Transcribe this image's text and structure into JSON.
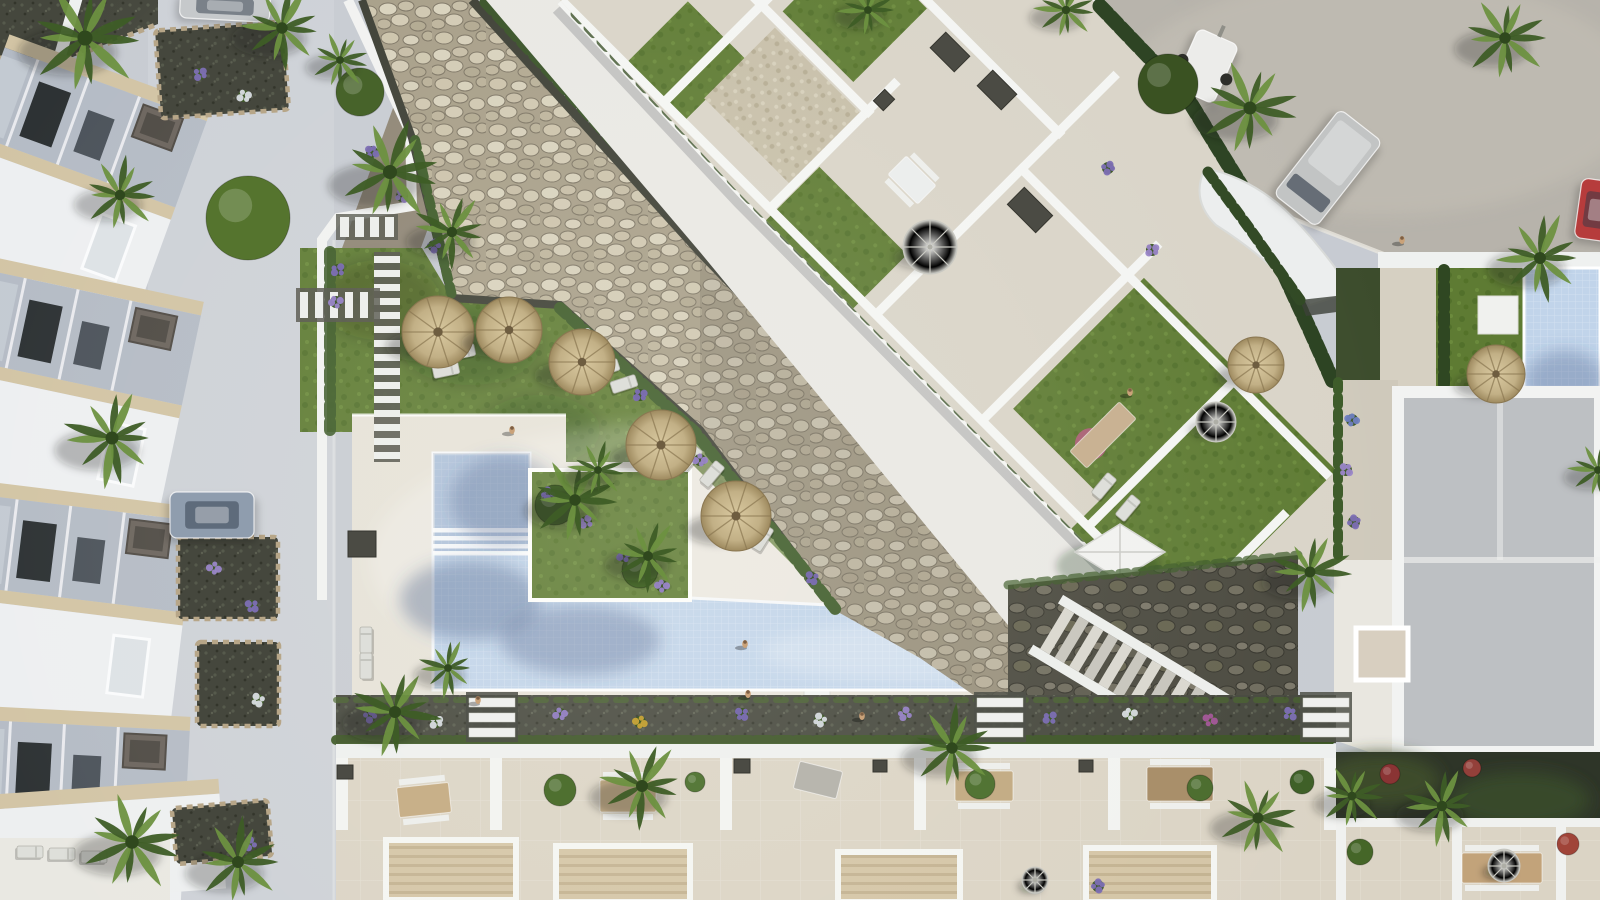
{
  "scene": {
    "kind": "aerial-architectural-render",
    "description": "Top-down 3D render of a Mediterranean residential complex: apartment block with roof terraces, communal lawn with thatched parasols, L-shaped pool, townhouse rows, streets with parked vehicles, stone bank and landscaped gardens",
    "palette": {
      "pavement": "#c7cbd2",
      "street": "#cdd1d7",
      "road": "#b7b3ab",
      "deck": "#e6e2d8",
      "walkway": "#e9e8e4",
      "wall_white": "#f2f3f2",
      "roof_white": "#edeff1",
      "eave_beige": "#d2c4a4",
      "facade": "#b4bbc5",
      "window_dark": "#2b3032",
      "lawn": "#5e7b33",
      "lawn_shade": "#47642a",
      "hedge": "#34501f",
      "riprap": "#a79e88",
      "stone_light": "#d8d2bd",
      "gravel_dark": "#45473d",
      "water": "#bfd3ea",
      "water_shadow": "#6e8cb8",
      "thatch": "#c9b88c",
      "terrace_tile": "#dbd4c5",
      "pergola": "#d0c1a2",
      "villa_roof": "#bdc0c3",
      "veg_dark": "#2e3528",
      "stone_border": "#b7a688"
    }
  },
  "left_houses": {
    "units": [
      {
        "y": 38,
        "rot": 20
      },
      {
        "y": 261,
        "rot": 12
      },
      {
        "y": 484,
        "rot": 7
      },
      {
        "y": 707,
        "rot": 3
      }
    ]
  },
  "objects": {
    "palms": [
      {
        "x": 85,
        "y": 38,
        "r": 58
      },
      {
        "x": 282,
        "y": 28,
        "r": 44
      },
      {
        "x": 390,
        "y": 172,
        "r": 54
      },
      {
        "x": 452,
        "y": 232,
        "r": 40
      },
      {
        "x": 120,
        "y": 195,
        "r": 40
      },
      {
        "x": 112,
        "y": 438,
        "r": 50
      },
      {
        "x": 132,
        "y": 842,
        "r": 52
      },
      {
        "x": 238,
        "y": 862,
        "r": 46
      },
      {
        "x": 575,
        "y": 500,
        "r": 44
      },
      {
        "x": 648,
        "y": 556,
        "r": 38
      },
      {
        "x": 598,
        "y": 470,
        "r": 30
      },
      {
        "x": 395,
        "y": 712,
        "r": 46
      },
      {
        "x": 448,
        "y": 668,
        "r": 30
      },
      {
        "x": 642,
        "y": 786,
        "r": 46
      },
      {
        "x": 952,
        "y": 748,
        "r": 44
      },
      {
        "x": 1258,
        "y": 818,
        "r": 42
      },
      {
        "x": 1442,
        "y": 806,
        "r": 40
      },
      {
        "x": 1352,
        "y": 796,
        "r": 34
      },
      {
        "x": 1310,
        "y": 572,
        "r": 42
      },
      {
        "x": 1250,
        "y": 108,
        "r": 50
      },
      {
        "x": 1505,
        "y": 38,
        "r": 44
      },
      {
        "x": 1540,
        "y": 258,
        "r": 46
      },
      {
        "x": 868,
        "y": 10,
        "r": 30
      },
      {
        "x": 1066,
        "y": 10,
        "r": 32
      },
      {
        "x": 340,
        "y": 60,
        "r": 30
      },
      {
        "x": 1598,
        "y": 470,
        "r": 30
      }
    ],
    "thatch_umbrellas": [
      {
        "x": 438,
        "y": 332,
        "r": 36
      },
      {
        "x": 509,
        "y": 330,
        "r": 33
      },
      {
        "x": 582,
        "y": 362,
        "r": 33
      },
      {
        "x": 661,
        "y": 445,
        "r": 35
      },
      {
        "x": 736,
        "y": 516,
        "r": 35
      },
      {
        "x": 1256,
        "y": 365,
        "r": 28
      },
      {
        "x": 1496,
        "y": 374,
        "r": 29
      }
    ],
    "patio_umbrellas": [
      {
        "x": 930,
        "y": 247,
        "r": 27
      },
      {
        "x": 1216,
        "y": 422,
        "r": 20
      },
      {
        "x": 1504,
        "y": 866,
        "r": 16
      },
      {
        "x": 1035,
        "y": 880,
        "r": 13
      }
    ],
    "sun_loungers": [
      {
        "x": 462,
        "y": 352,
        "rot": 78
      },
      {
        "x": 446,
        "y": 370,
        "rot": 78
      },
      {
        "x": 606,
        "y": 368,
        "rot": 72
      },
      {
        "x": 624,
        "y": 384,
        "rot": 72
      },
      {
        "x": 690,
        "y": 458,
        "rot": 40
      },
      {
        "x": 712,
        "y": 474,
        "rot": 40
      },
      {
        "x": 762,
        "y": 538,
        "rot": 32
      },
      {
        "x": 1104,
        "y": 486,
        "rot": 40
      },
      {
        "x": 1128,
        "y": 508,
        "rot": 40
      },
      {
        "x": 366,
        "y": 640,
        "rot": 0
      },
      {
        "x": 366,
        "y": 666,
        "rot": 0
      },
      {
        "x": 30,
        "y": 852,
        "rot": 90
      },
      {
        "x": 62,
        "y": 854,
        "rot": 90
      },
      {
        "x": 94,
        "y": 857,
        "rot": 90
      }
    ],
    "people": [
      {
        "x": 512,
        "y": 430
      },
      {
        "x": 745,
        "y": 644
      },
      {
        "x": 748,
        "y": 694
      },
      {
        "x": 478,
        "y": 700
      },
      {
        "x": 1402,
        "y": 240
      },
      {
        "x": 1130,
        "y": 392
      },
      {
        "x": 862,
        "y": 716
      }
    ],
    "vehicles": [
      {
        "kind": "car",
        "x": 225,
        "y": 6,
        "w": 90,
        "h": 28,
        "rot": 3,
        "color": "#c6c9cb"
      },
      {
        "kind": "car",
        "x": 212,
        "y": 515,
        "w": 84,
        "h": 46,
        "rot": 0,
        "color": "#8f9dae"
      },
      {
        "kind": "van",
        "x": 1328,
        "y": 168,
        "w": 54,
        "h": 108,
        "rot": 38,
        "color": "#c2c4c4"
      },
      {
        "kind": "trailer",
        "x": 1206,
        "y": 66,
        "w": 44,
        "h": 64,
        "rot": 24,
        "color": "#ececea"
      },
      {
        "kind": "car",
        "x": 1596,
        "y": 210,
        "w": 36,
        "h": 60,
        "rot": 8,
        "color": "#b63c3c"
      }
    ],
    "planting_beds": [
      {
        "x": 222,
        "y": 70,
        "w": 128,
        "h": 88,
        "rot": -4
      },
      {
        "x": 228,
        "y": 578,
        "w": 100,
        "h": 82,
        "rot": 0
      },
      {
        "x": 238,
        "y": 684,
        "w": 82,
        "h": 84,
        "rot": 0
      },
      {
        "x": 222,
        "y": 832,
        "w": 96,
        "h": 56,
        "rot": -5
      }
    ],
    "step_paths": [
      {
        "x": 492,
        "y": 698
      },
      {
        "x": 1000,
        "y": 698
      },
      {
        "x": 1326,
        "y": 698
      }
    ],
    "sphere_lamps": [
      {
        "x": 1504,
        "y": 864,
        "r": 15
      },
      {
        "x": 1035,
        "y": 882,
        "r": 12
      }
    ],
    "bushes": [
      {
        "x": 248,
        "y": 218,
        "r": 42,
        "c": "#55742e"
      },
      {
        "x": 360,
        "y": 92,
        "r": 24,
        "c": "#47632a"
      },
      {
        "x": 1168,
        "y": 84,
        "r": 30,
        "c": "#3a5222"
      },
      {
        "x": 560,
        "y": 790,
        "r": 16,
        "c": "#4f7030"
      },
      {
        "x": 980,
        "y": 784,
        "r": 15,
        "c": "#527434"
      },
      {
        "x": 1200,
        "y": 788,
        "r": 13,
        "c": "#4d6e30"
      },
      {
        "x": 695,
        "y": 782,
        "r": 10,
        "c": "#57793a"
      },
      {
        "x": 1302,
        "y": 782,
        "r": 12,
        "c": "#3f6028"
      },
      {
        "x": 1360,
        "y": 852,
        "r": 13,
        "c": "#456628"
      },
      {
        "x": 1568,
        "y": 844,
        "r": 11,
        "c": "#a04438"
      },
      {
        "x": 1390,
        "y": 774,
        "r": 10,
        "c": "#8a3434"
      },
      {
        "x": 1472,
        "y": 768,
        "r": 9,
        "c": "#93403a"
      },
      {
        "x": 555,
        "y": 505,
        "r": 20,
        "c": "#44612c"
      },
      {
        "x": 640,
        "y": 570,
        "r": 18,
        "c": "#4a6a2e"
      }
    ],
    "flower_clusters": [
      {
        "x": 370,
        "y": 716,
        "c": "#7d6fb4"
      },
      {
        "x": 436,
        "y": 722,
        "c": "#d9dde2"
      },
      {
        "x": 560,
        "y": 714,
        "c": "#9a86c8"
      },
      {
        "x": 640,
        "y": 722,
        "c": "#c9a53a"
      },
      {
        "x": 742,
        "y": 714,
        "c": "#7d6fb4"
      },
      {
        "x": 820,
        "y": 720,
        "c": "#d9dde2"
      },
      {
        "x": 905,
        "y": 714,
        "c": "#9a86c8"
      },
      {
        "x": 1050,
        "y": 718,
        "c": "#7d6fb4"
      },
      {
        "x": 1130,
        "y": 714,
        "c": "#d9dde2"
      },
      {
        "x": 1210,
        "y": 720,
        "c": "#a4589a"
      },
      {
        "x": 1290,
        "y": 714,
        "c": "#7d6fb4"
      },
      {
        "x": 1098,
        "y": 886,
        "c": "#7d6fb4"
      },
      {
        "x": 585,
        "y": 335,
        "c": "#d9dde2"
      },
      {
        "x": 640,
        "y": 395,
        "c": "#7d6fb4"
      },
      {
        "x": 700,
        "y": 460,
        "c": "#9a86c8"
      },
      {
        "x": 760,
        "y": 525,
        "c": "#d9dde2"
      },
      {
        "x": 812,
        "y": 578,
        "c": "#7d6fb4"
      },
      {
        "x": 548,
        "y": 494,
        "c": "#7d6fb4"
      },
      {
        "x": 586,
        "y": 522,
        "c": "#9a86c8"
      },
      {
        "x": 624,
        "y": 556,
        "c": "#7d6fb4"
      },
      {
        "x": 662,
        "y": 586,
        "c": "#9a86c8"
      },
      {
        "x": 372,
        "y": 152,
        "c": "#7d6fb4"
      },
      {
        "x": 402,
        "y": 196,
        "c": "#9a86c8"
      },
      {
        "x": 434,
        "y": 246,
        "c": "#7d6fb4"
      },
      {
        "x": 200,
        "y": 74,
        "c": "#7d6fb4"
      },
      {
        "x": 244,
        "y": 96,
        "c": "#d9dde2"
      },
      {
        "x": 214,
        "y": 568,
        "c": "#9a86c8"
      },
      {
        "x": 252,
        "y": 606,
        "c": "#7d6fb4"
      },
      {
        "x": 258,
        "y": 700,
        "c": "#d9dde2"
      },
      {
        "x": 250,
        "y": 844,
        "c": "#7d6fb4"
      },
      {
        "x": 338,
        "y": 270,
        "c": "#7d6fb4"
      },
      {
        "x": 336,
        "y": 302,
        "c": "#9a86c8"
      },
      {
        "x": 1352,
        "y": 420,
        "c": "#6f7fc0"
      },
      {
        "x": 1346,
        "y": 470,
        "c": "#9a86c8"
      },
      {
        "x": 1354,
        "y": 522,
        "c": "#7d6fb4"
      },
      {
        "x": 1108,
        "y": 168,
        "c": "#7d6fb4"
      },
      {
        "x": 1152,
        "y": 250,
        "c": "#9a86c8"
      }
    ],
    "tables": [
      {
        "x": 424,
        "y": 800,
        "w": 52,
        "h": 30,
        "rot": -6,
        "c": "#c8b089",
        "chairs": true
      },
      {
        "x": 628,
        "y": 796,
        "w": 56,
        "h": 32,
        "rot": 0,
        "c": "#cbb48e",
        "chairs": true
      },
      {
        "x": 818,
        "y": 780,
        "w": 44,
        "h": 28,
        "rot": 14,
        "c": "#b8b6ae",
        "chairs": false
      },
      {
        "x": 984,
        "y": 786,
        "w": 58,
        "h": 30,
        "rot": 0,
        "c": "#c4ad86",
        "chairs": true
      },
      {
        "x": 1180,
        "y": 784,
        "w": 66,
        "h": 34,
        "rot": 0,
        "c": "#a98f6a",
        "chairs": true
      },
      {
        "x": 1502,
        "y": 868,
        "w": 80,
        "h": 30,
        "rot": 0,
        "c": "#c2a37a",
        "chairs": true
      },
      {
        "x": 912,
        "y": 180,
        "w": 42,
        "h": 26,
        "rot": 45,
        "c": "#eceeed",
        "chairs": true
      },
      {
        "x": 1103,
        "y": 435,
        "w": 24,
        "h": 70,
        "rot": 45,
        "c": "#c9b293",
        "chairs": false
      }
    ],
    "dark_boxes": [
      {
        "x": 345,
        "y": 772,
        "w": 16,
        "h": 14,
        "rot": 0
      },
      {
        "x": 742,
        "y": 766,
        "w": 16,
        "h": 14,
        "rot": 0
      },
      {
        "x": 880,
        "y": 766,
        "w": 14,
        "h": 12,
        "rot": 0
      },
      {
        "x": 1086,
        "y": 766,
        "w": 14,
        "h": 12,
        "rot": 0
      },
      {
        "x": 362,
        "y": 544,
        "w": 28,
        "h": 26,
        "rot": 0
      },
      {
        "x": 950,
        "y": 52,
        "w": 34,
        "h": 22,
        "rot": 45
      },
      {
        "x": 884,
        "y": 100,
        "w": 14,
        "h": 16,
        "rot": 45
      },
      {
        "x": 997,
        "y": 90,
        "w": 34,
        "h": 22,
        "rot": 45
      },
      {
        "x": 1030,
        "y": 210,
        "w": 40,
        "h": 24,
        "rot": 45
      }
    ]
  }
}
